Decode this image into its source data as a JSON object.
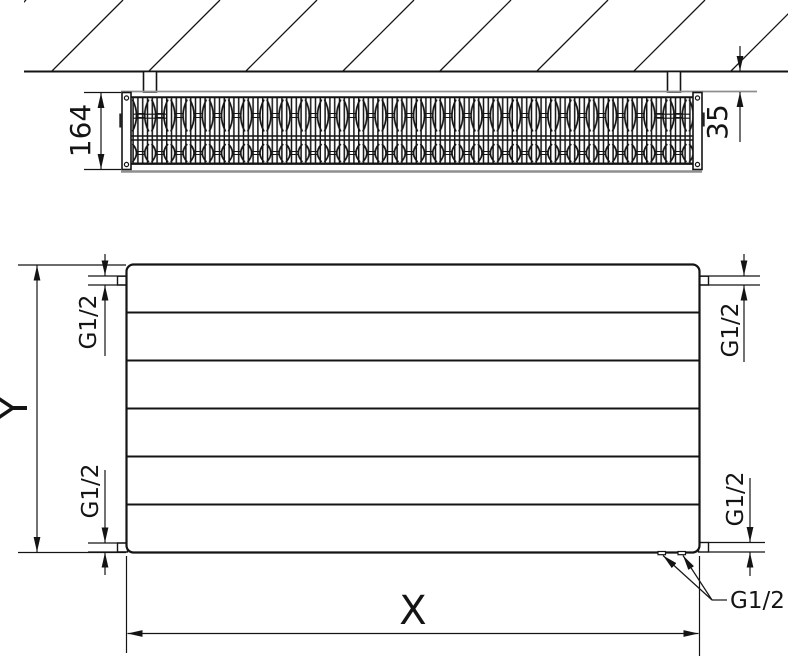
{
  "colors": {
    "line": "#141414",
    "grille_line": "#8f8f8f",
    "background": "#ffffff"
  },
  "top_view": {
    "depth_label": "164",
    "wall_clearance_label": "35"
  },
  "front_view": {
    "height_label": "Y",
    "width_label": "X",
    "connections": {
      "top_left": "G1/2",
      "bottom_left": "G1/2",
      "top_right": "G1/2",
      "bottom_right": "G1/2",
      "bottom": "G1/2"
    }
  }
}
